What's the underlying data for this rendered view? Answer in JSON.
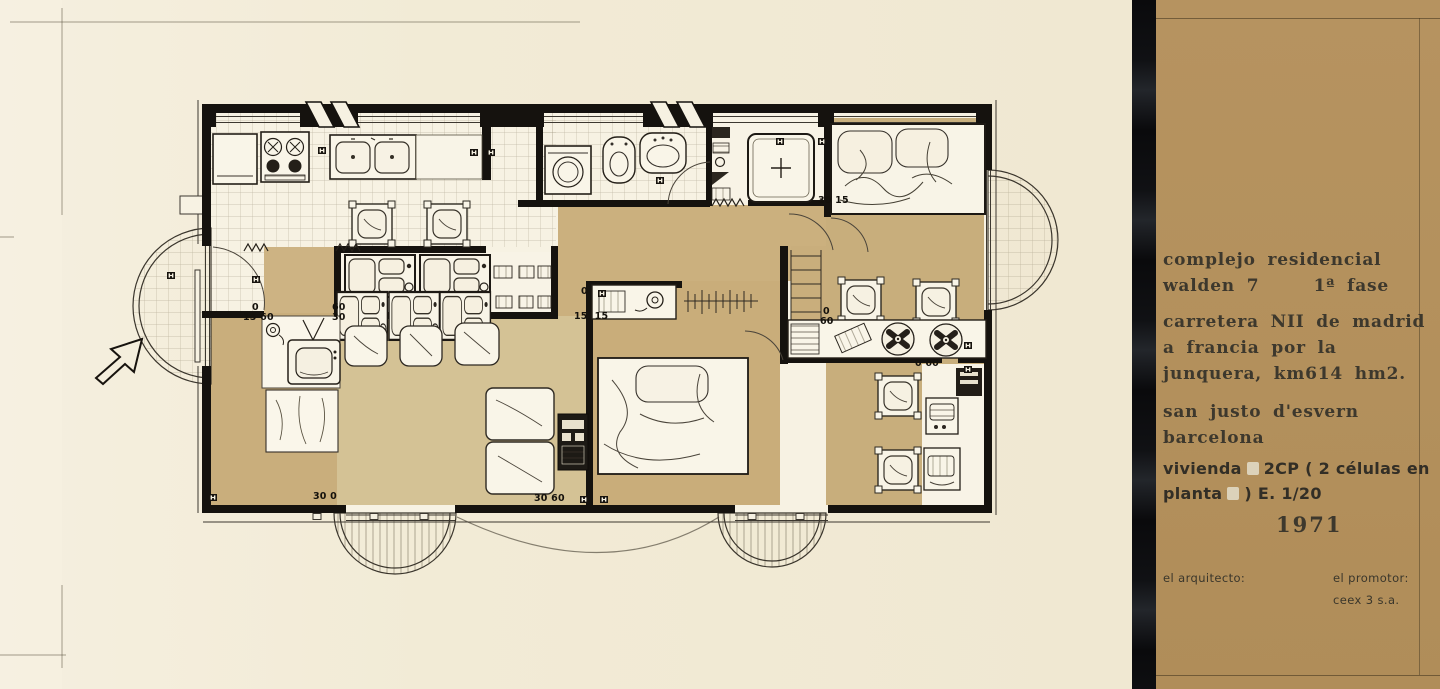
{
  "title_block": {
    "line1": "complejo residencial",
    "line2_left": "walden 7",
    "line2_right": "1ª fase",
    "line3": "carretera NII de madrid",
    "line4": "a francia por la",
    "line5": "junquera, km614  hm2.",
    "line6": "san justo d'esvern",
    "line7": "barcelona",
    "dwelling_line1_a": "vivienda",
    "dwelling_line1_b": "2CP ( 2 células en",
    "dwelling_line2_a": "planta",
    "dwelling_line2_b": ") E. 1/20",
    "year": "1971",
    "architect_label": "el arquitecto:",
    "promoter_label": "el promotor:",
    "promoter_name": "ceex 3 s.a."
  },
  "plan": {
    "dimension_labels": [
      {
        "text": "0",
        "x": 252,
        "y": 303
      },
      {
        "text": "15 60",
        "x": 243,
        "y": 313
      },
      {
        "text": "60",
        "x": 332,
        "y": 303
      },
      {
        "text": "30",
        "x": 332,
        "y": 313
      },
      {
        "text": "0",
        "x": 581,
        "y": 287
      },
      {
        "text": "15  15",
        "x": 574,
        "y": 312
      },
      {
        "text": "30 15",
        "x": 818,
        "y": 196
      },
      {
        "text": "0",
        "x": 823,
        "y": 307
      },
      {
        "text": "60",
        "x": 820,
        "y": 317
      },
      {
        "text": "0 60",
        "x": 915,
        "y": 359
      },
      {
        "text": "30 0",
        "x": 313,
        "y": 492
      },
      {
        "text": "30 60",
        "x": 534,
        "y": 494
      }
    ]
  },
  "colors": {
    "paper": "#f2ebd7",
    "floor_tan": "#c9ae7c",
    "floor_tan_light": "#d4c295",
    "panel_tan": "#b4915d",
    "ink": "#17130e"
  }
}
